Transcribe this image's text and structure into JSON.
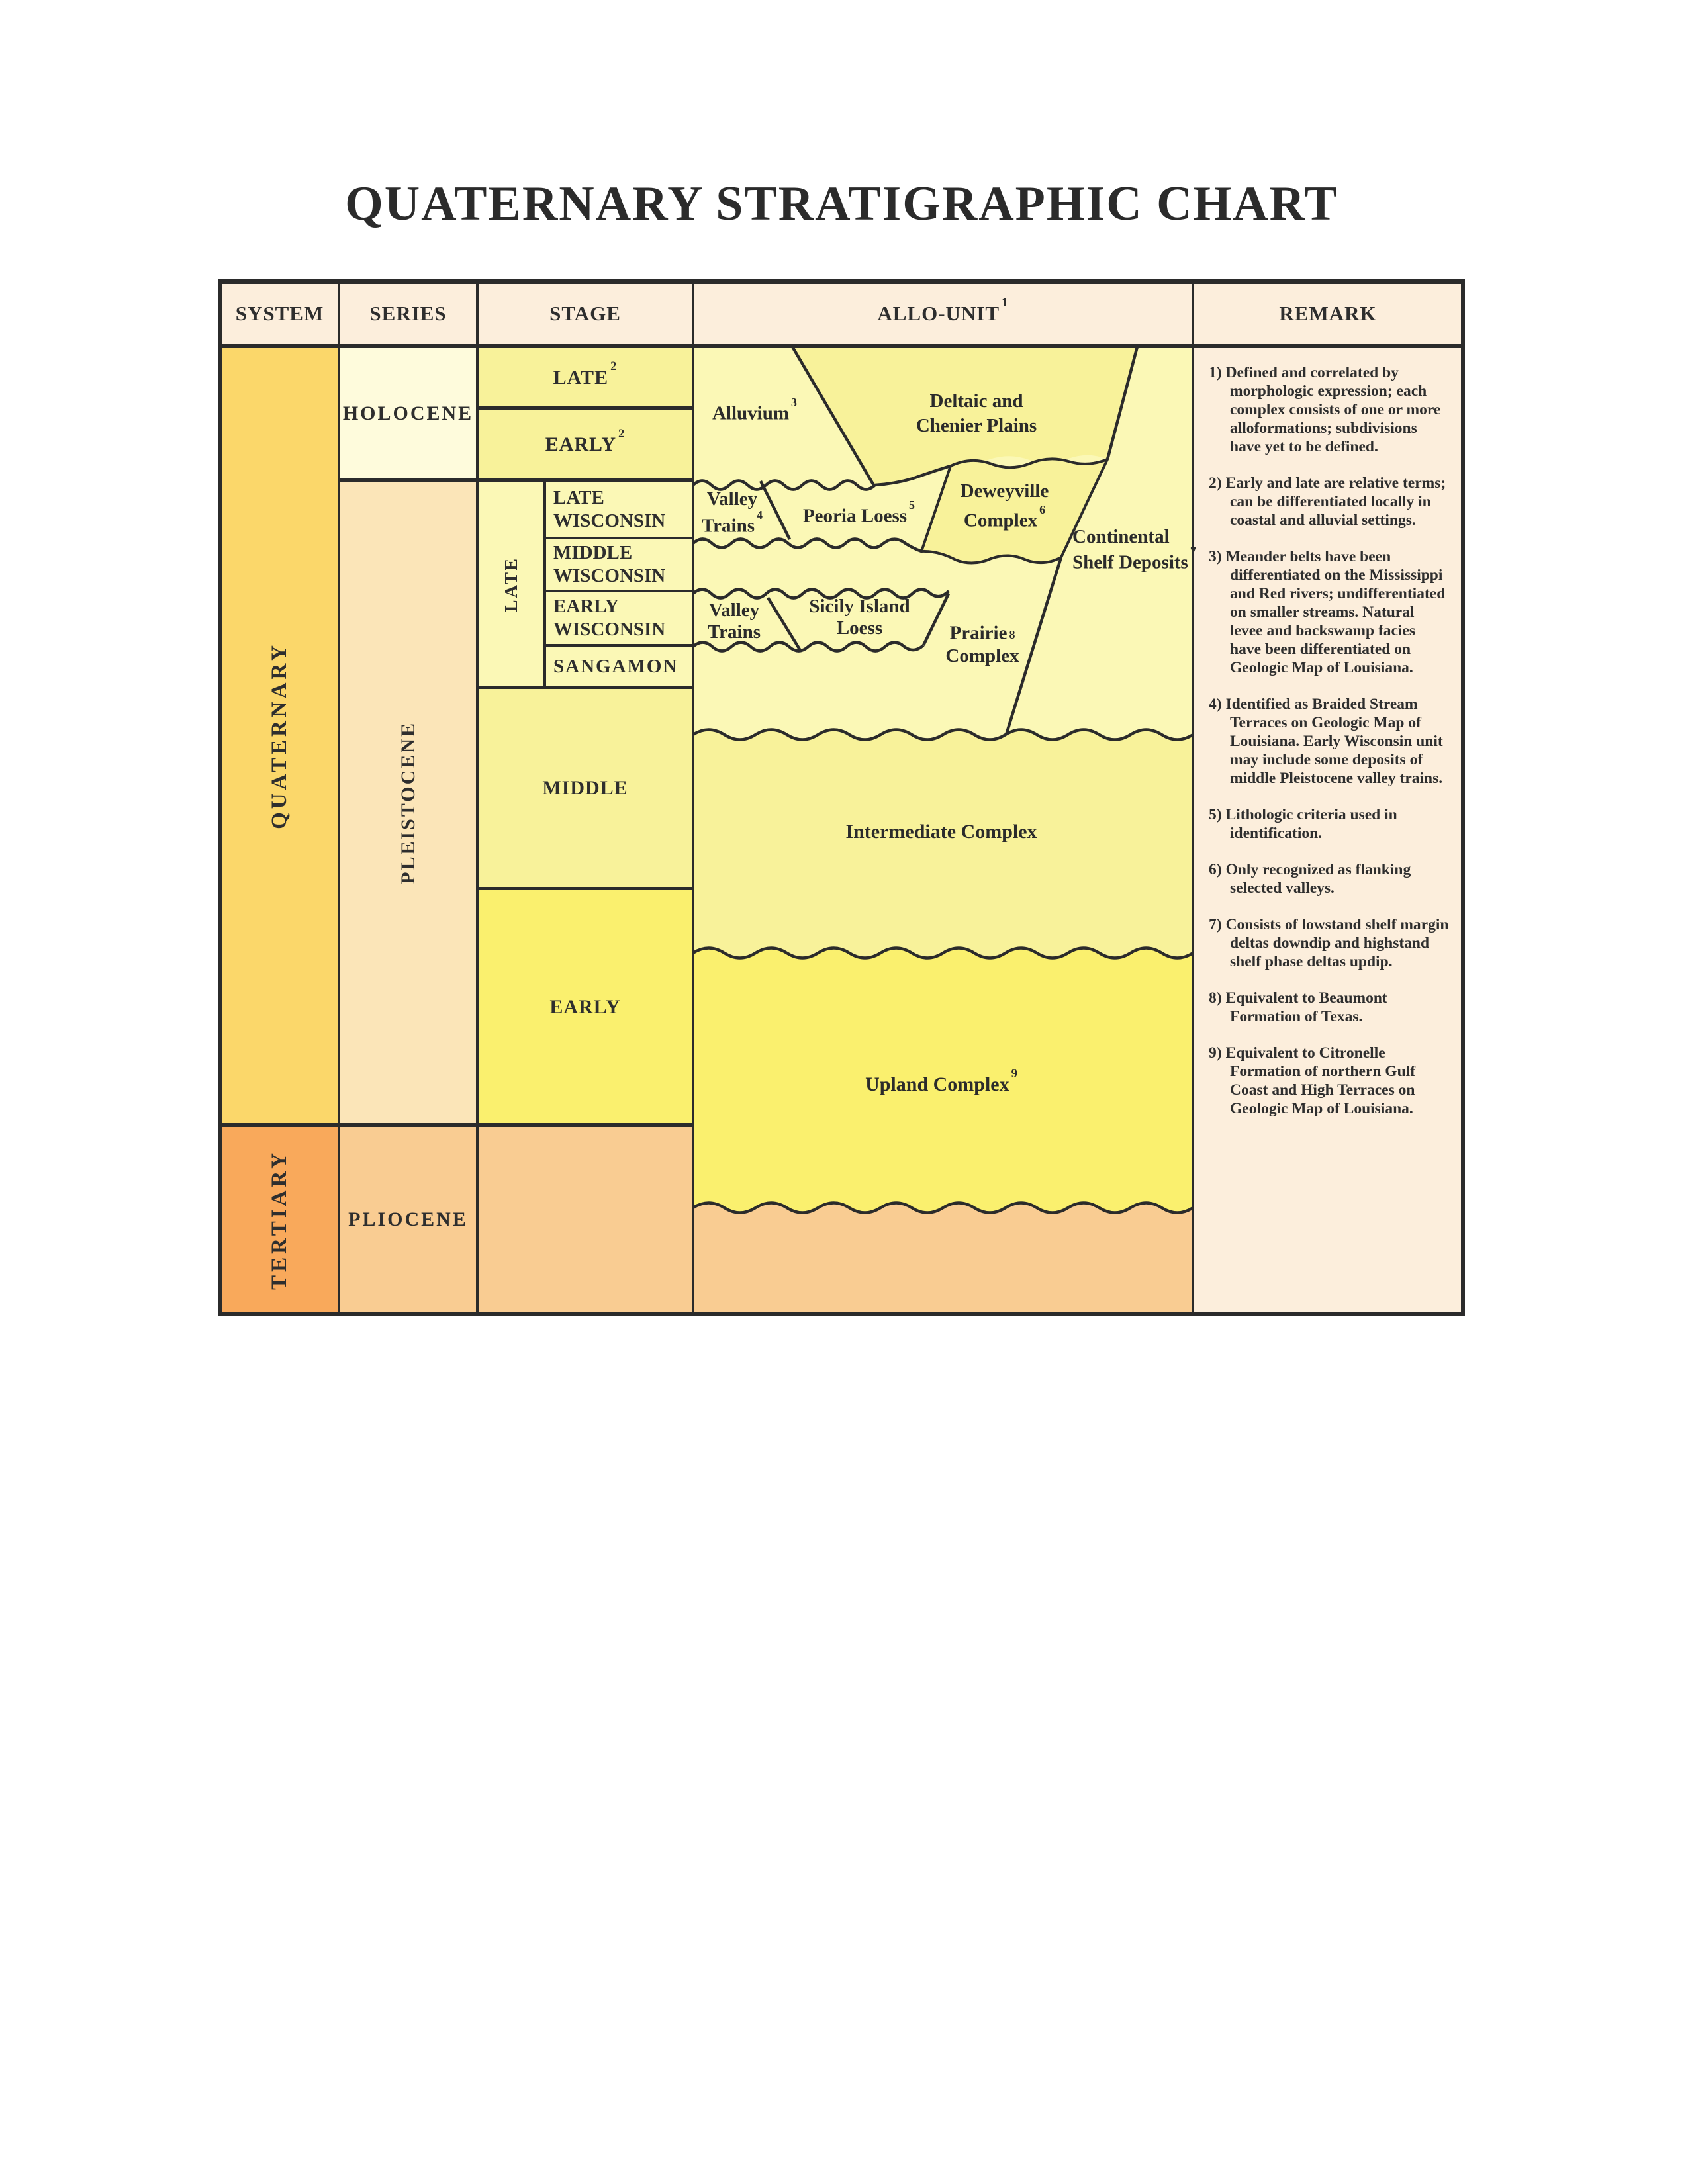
{
  "title": "QUATERNARY STRATIGRAPHIC CHART",
  "headers": {
    "system": "SYSTEM",
    "series": "SERIES",
    "stage": "STAGE",
    "allo_unit": {
      "label": "ALLO-UNIT",
      "sup": "1"
    },
    "remark": "REMARK"
  },
  "system": {
    "quaternary": "QUATERNARY",
    "tertiary": "TERTIARY"
  },
  "series": {
    "holocene": "HOLOCENE",
    "pleistocene": "PLEISTOCENE",
    "pliocene": "PLIOCENE"
  },
  "stage": {
    "late_holocene": {
      "label": "LATE",
      "sup": "2"
    },
    "early_holocene": {
      "label": "EARLY",
      "sup": "2"
    },
    "late_group": "LATE",
    "late_wisconsin": "LATE WISCONSIN",
    "middle_wisconsin": "MIDDLE WISCONSIN",
    "early_wisconsin": "EARLY WISCONSIN",
    "sangamon": "SANGAMON",
    "middle": "MIDDLE",
    "early": "EARLY"
  },
  "allo": {
    "alluvium": {
      "label": "Alluvium",
      "sup": "3"
    },
    "deltaic": "Deltaic and Chenier Plains",
    "valley_trains_1": {
      "label": "Valley Trains",
      "sup": "4"
    },
    "peoria": {
      "label": "Peoria Loess",
      "sup": "5"
    },
    "deweyville": {
      "label": "Deweyville Complex",
      "sup": "6"
    },
    "continental": {
      "label": "Continental Shelf Deposits",
      "sup": "7"
    },
    "valley_trains_2": "Valley Trains",
    "sicily": "Sicily Island Loess",
    "prairie": {
      "label": "Prairie",
      "line2": "Complex",
      "sup": "8"
    },
    "intermediate": "Intermediate Complex",
    "upland": {
      "label": "Upland Complex",
      "sup": "9"
    }
  },
  "remarks": [
    {
      "num": "1)",
      "text": "Defined and correlated by morphologic expression; each complex consists of one or more alloformations; subdivisions have yet to be defined."
    },
    {
      "num": "2)",
      "text": "Early and late are relative terms; can be differentiated locally in coastal and alluvial settings."
    },
    {
      "num": "3)",
      "text": "Meander belts have been differentiated on the Mississippi and Red rivers; undifferentiated on smaller streams. Natural levee and backswamp facies have been differentiated on Geologic Map of Louisiana."
    },
    {
      "num": "4)",
      "text": "Identified as Braided Stream Terraces on Geologic Map of Louisiana. Early Wisconsin unit may include some deposits of middle Pleistocene valley trains."
    },
    {
      "num": "5)",
      "text": "Lithologic criteria used in identification."
    },
    {
      "num": "6)",
      "text": "Only recognized as flanking selected valleys."
    },
    {
      "num": "7)",
      "text": "Consists of lowstand shelf margin deltas downdip and highstand shelf phase deltas updip."
    },
    {
      "num": "8)",
      "text": "Equivalent to Beaumont Formation of Texas."
    },
    {
      "num": "9)",
      "text": "Equivalent to Citronelle Formation of northern Gulf Coast and High Terraces on Geologic Map of Louisiana."
    }
  ],
  "colors": {
    "line": "#2b2b2b",
    "header_bg": "#FCEEDC",
    "quaternary_gold": "#FBD76A",
    "tertiary_orange": "#F9A95B",
    "holocene_cream": "#FEFBDC",
    "pleistocene_peach": "#FBE5B8",
    "pliocene_orange": "#F9CC92",
    "pale_yellow": "#FBF8B6",
    "medium_yellow": "#F8F29A",
    "bright_yellow": "#FAF06E"
  }
}
